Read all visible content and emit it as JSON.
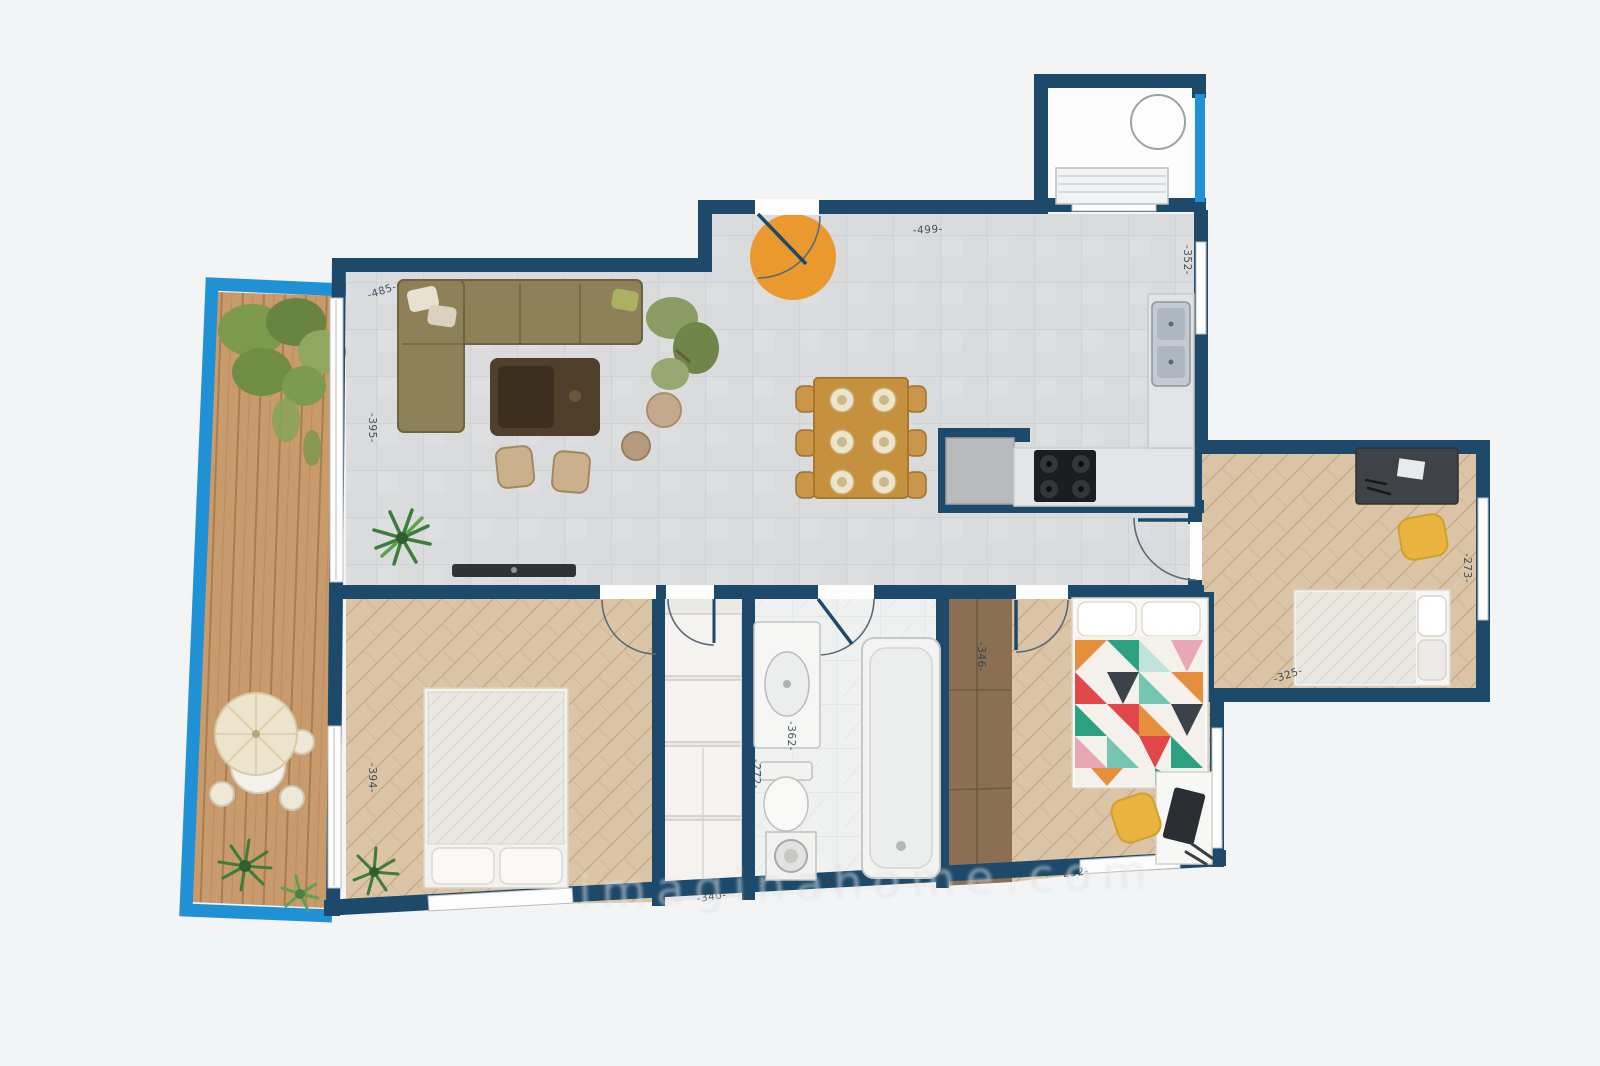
{
  "title": "Apartment floor plan",
  "colors": {
    "bg": "#f3f4f5",
    "wall": "#1d4a6b",
    "railing": "#2191d6",
    "tile": "#d9dbdc",
    "wood": "#dcc5a6",
    "deck": "#c89a6c",
    "bath": "#eff0f0",
    "wardrobe": "#8a6f52",
    "accent": "#e9992e",
    "chair": "#e9b33d",
    "label": "#2c3e50"
  },
  "dimensions": {
    "living_top": "-485-",
    "entry_top": "-499-",
    "living_left": "-395-",
    "kitchen_right": "-352-",
    "bedroom3_right": "-273-",
    "bedroom3_bottom": "-325-",
    "bedroom1_left": "-394-",
    "wardrobe_side": "-346-",
    "bathroom_height": "-362-",
    "bathroom_left": "-272-",
    "bedroom1_bottom": "-337-",
    "closet_bottom": "-340-",
    "bathroom_bottom": "-238-",
    "bedroom2_bottom": "-252-"
  },
  "watermark": "imaginahome.com"
}
